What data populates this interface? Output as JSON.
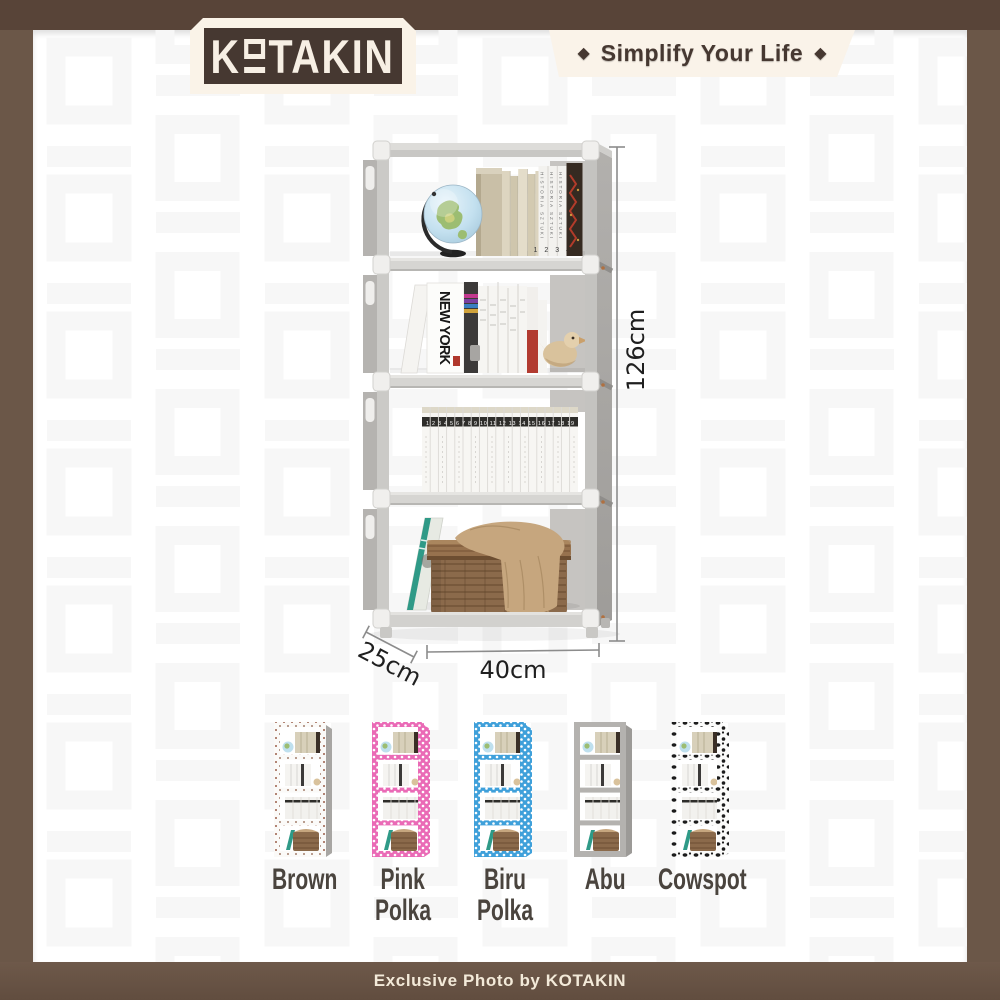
{
  "header": {
    "logo": {
      "prefix": "K",
      "suffix": "TAKIN"
    },
    "tagline": "Simplify Your Life",
    "diamond": "◆"
  },
  "product": {
    "dimensions": {
      "height": "126cm",
      "width": "40cm",
      "depth": "25cm"
    },
    "shelf_books": {
      "top_spine_text": "HISTORIA SZTUKI",
      "top_spine_numbers": "1 2 3 4",
      "middle_cover_text": "NEW YORK",
      "volume_numbers": "1 2 3 4 5 6 7 8 9 10 11 12 13 14 15 16 17 18 19"
    }
  },
  "variants": [
    {
      "name": "Brown",
      "lines": [
        "Brown"
      ]
    },
    {
      "name": "Pink Polka",
      "lines": [
        "Pink",
        "Polka"
      ]
    },
    {
      "name": "Biru Polka",
      "lines": [
        "Biru",
        "Polka"
      ]
    },
    {
      "name": "Abu",
      "lines": [
        "Abu"
      ]
    },
    {
      "name": "Cowspot",
      "lines": [
        "Cowspot"
      ]
    }
  ],
  "footer": {
    "credit": "Exclusive Photo by KOTAKIN"
  },
  "colors": {
    "frame_brown": "#6b5748",
    "frame_top_brown": "#584438",
    "cream": "#faf3e8",
    "dark_brown_text": "#463831",
    "shelf_gray": "#a9a7a3",
    "pink_polka": "#ea6ab6",
    "biru_polka": "#3fa0da",
    "abu_gray": "#b4b2af",
    "teal_book": "#2f9a87",
    "basket_brown": "#8b6a4b"
  }
}
